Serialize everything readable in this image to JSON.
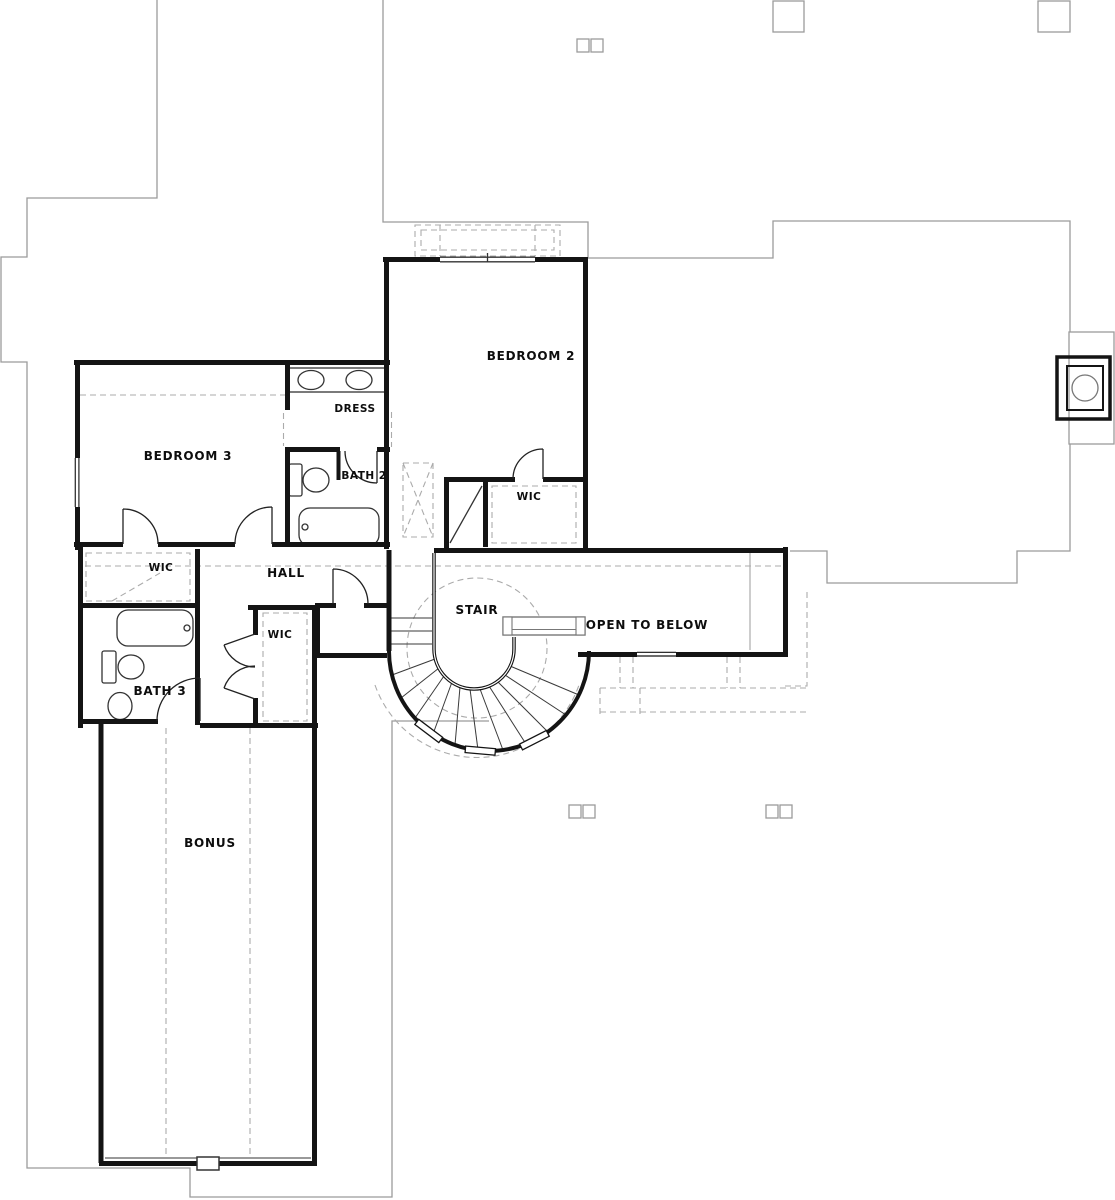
{
  "plan": {
    "rooms": {
      "bedroom2": "BEDROOM 2",
      "bedroom3": "BEDROOM 3",
      "dress": "DRESS",
      "bath2": "BATH 2",
      "bath3": "BATH 3",
      "wic_bedroom2": "WIC",
      "wic_bedroom3": "WIC",
      "wic_hall": "WIC",
      "hall": "HALL",
      "stair": "STAIR",
      "open_to_below": "OPEN TO BELOW",
      "bonus": "BONUS"
    },
    "colors": {
      "wall": "#141414",
      "roofline": "#9b9b9b",
      "dashed": "#ababab",
      "fixture": "#333333",
      "label": "#0d0d0d",
      "background": "#ffffff"
    }
  }
}
